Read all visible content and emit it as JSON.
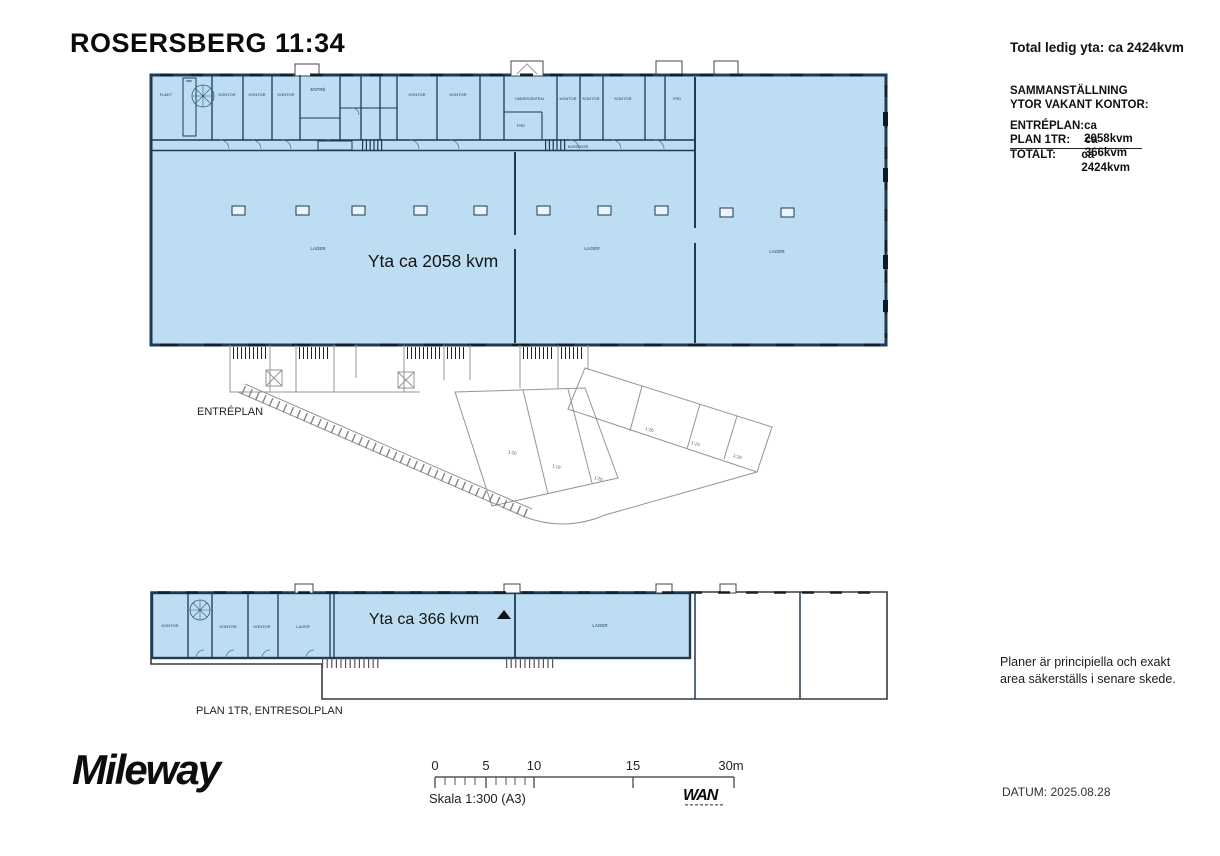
{
  "header": {
    "title": "ROSERSBERG 11:34"
  },
  "summary": {
    "total_label": "Total ledig yta: ca 2424kvm",
    "heading_line1": "SAMMANSTÄLLNING",
    "heading_line2": "YTOR VAKANT KONTOR:",
    "rows": [
      {
        "label": "ENTRÉPLAN:",
        "value": "ca 2058kvm"
      },
      {
        "label": "PLAN 1TR:",
        "value": "ca 366kvm"
      },
      {
        "label": "TOTALT:",
        "value": "ca 2424kvm"
      }
    ]
  },
  "entreplan": {
    "caption": "ENTRÉPLAN",
    "area_label": "Yta ca 2058 kvm",
    "rooms": {
      "flakt": "FLÄKT",
      "kontor1": "KONTOR",
      "kontor2": "KONTOR",
      "kontor3": "KONTOR",
      "entre": "ENTRÉ",
      "kontor4": "KONTOR",
      "kontor5": "KONTOR",
      "undercentral": "UNDERCENTRAL",
      "frd1": "FRD",
      "kontor6": "KONTOR",
      "kontor7": "KONTOR",
      "kontor8": "KONTOR",
      "frd2": "FRD",
      "korridor": "KORRIDOR",
      "lager1": "LAGER",
      "lager2": "LAGER",
      "lager3": "LAGER"
    }
  },
  "plan1tr": {
    "caption": "PLAN 1TR, ENTRESOLPLAN",
    "area_label": "Yta ca 366 kvm",
    "rooms": {
      "kontor1": "KONTOR",
      "kontor2": "KONTOR",
      "kontor3": "KONTOR",
      "lager1": "LAGER",
      "lager2": "LAGER"
    }
  },
  "annex": {
    "plots": [
      "1:20",
      "1:10",
      "1:20",
      "1:20",
      "1:19",
      "1:20"
    ]
  },
  "notes": {
    "line1": "Planer är principiella och exakt",
    "line2": "area säkerställs i senare skede."
  },
  "footer": {
    "brand": "Mileway",
    "scale_ticks": [
      "0",
      "5",
      "10",
      "15",
      "30m"
    ],
    "scale_label": "Skala 1:300 (A3)",
    "architect_mark": "WAN",
    "date_label": "DATUM: 2025.08.28"
  },
  "colors": {
    "highlight": "#BDDDF2",
    "wall": "#1D3A57"
  }
}
